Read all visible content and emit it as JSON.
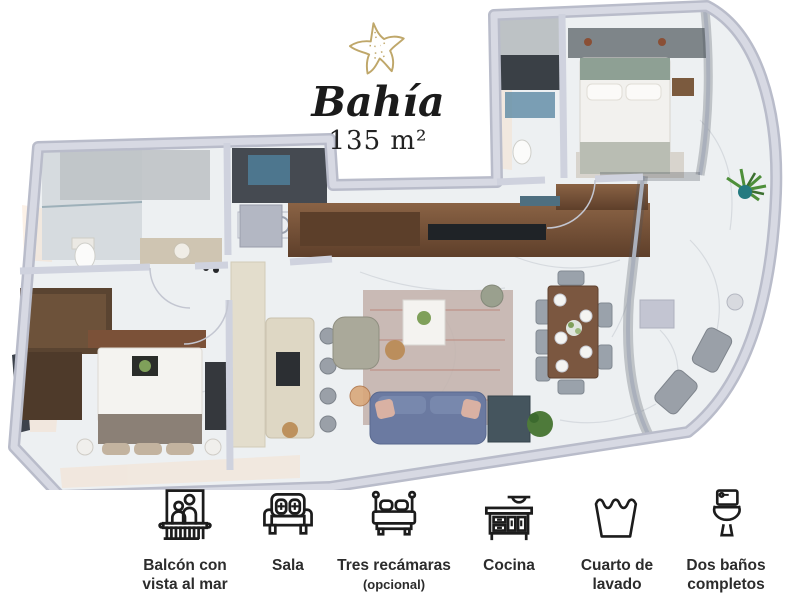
{
  "title": {
    "name": "Bahía",
    "area": "135 m²",
    "logo_icon": "starfish-icon"
  },
  "floor_plan": {
    "name": "Bahía apartment 3D top-view floor plan",
    "area_label": "135 m²",
    "colors": {
      "wall": "#cfd2de",
      "floor_marble": "#edf0f2",
      "wood": "#7a5740",
      "sofa_blue": "#6b7aa1",
      "accent_gold": "#bfa76a",
      "plant_green": "#4e8f3a"
    }
  },
  "amenities": [
    {
      "icon": "balcony-icon",
      "label": "Balcón con vista al mar"
    },
    {
      "icon": "sofa-icon",
      "label": "Sala"
    },
    {
      "icon": "bed-icon",
      "label": "Tres recámaras",
      "note": "(opcional)"
    },
    {
      "icon": "kitchen-icon",
      "label": "Cocina"
    },
    {
      "icon": "laundry-icon",
      "label": "Cuarto de lavado"
    },
    {
      "icon": "toilet-icon",
      "label": "Dos baños completos"
    }
  ]
}
